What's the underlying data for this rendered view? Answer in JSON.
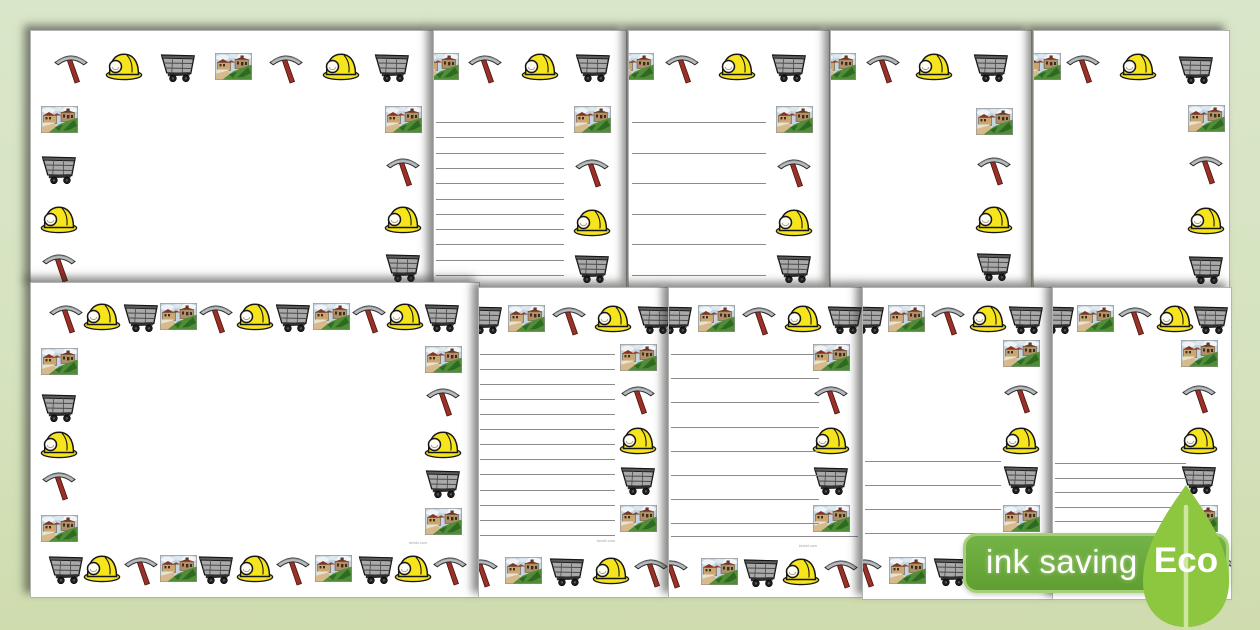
{
  "background_color": "#d6e3c0",
  "page_color": "#ffffff",
  "theme_icons": [
    "pickaxe-icon",
    "mining-helmet-icon",
    "mine-cart-icon",
    "colliery-scene-icon"
  ],
  "watermark_text": "twinkl.com",
  "badge": {
    "label": "ink saving",
    "eco_label": "Eco",
    "badge_color": "#68a93c",
    "badge_border_color": "#a6d075",
    "leaf_color": "#8dc63f",
    "stem_color": "#cde6a0",
    "text_color": "#ffffff"
  },
  "icon_colors": {
    "helmet_yellow": "#f6e41c",
    "pickaxe_handle_red": "#993128",
    "pickaxe_head_grey": "#b9bcbf",
    "cart_grey": "#a9a9a9",
    "scene_sky": "#c4d4e0",
    "scene_grass": "#4f8e36",
    "scene_roof": "#8a3325"
  },
  "pages": [
    {
      "name": "page-landscape-border-blank-top",
      "description": "landscape page border, blank, partially hidden",
      "x": 30,
      "y": 30,
      "w": 404,
      "h": 257,
      "z": 1,
      "icons": [
        {
          "t": "pickaxe",
          "x": 40,
          "y": 35
        },
        {
          "t": "helmet",
          "x": 93,
          "y": 35
        },
        {
          "t": "cart",
          "x": 147,
          "y": 35
        },
        {
          "t": "scene",
          "x": 202,
          "y": 35
        },
        {
          "t": "pickaxe",
          "x": 255,
          "y": 35
        },
        {
          "t": "helmet",
          "x": 310,
          "y": 35
        },
        {
          "t": "cart",
          "x": 361,
          "y": 35
        },
        {
          "t": "scene",
          "x": 28,
          "y": 88
        },
        {
          "t": "cart",
          "x": 28,
          "y": 137
        },
        {
          "t": "helmet",
          "x": 28,
          "y": 188
        },
        {
          "t": "pickaxe",
          "x": 28,
          "y": 234
        },
        {
          "t": "scene",
          "x": 372,
          "y": 88
        },
        {
          "t": "pickaxe",
          "x": 372,
          "y": 138
        },
        {
          "t": "helmet",
          "x": 372,
          "y": 188
        },
        {
          "t": "cart",
          "x": 372,
          "y": 235
        }
      ],
      "lines": [],
      "watermark": null
    },
    {
      "name": "page-portrait-narrow-lined-top",
      "description": "portrait border with narrow writing lines, partially hidden",
      "x": 433,
      "y": 30,
      "w": 194,
      "h": 258,
      "z": 2,
      "icons": [
        {
          "t": "scene",
          "x": 6,
          "y": 35
        },
        {
          "t": "pickaxe",
          "x": 51,
          "y": 35
        },
        {
          "t": "helmet",
          "x": 106,
          "y": 35
        },
        {
          "t": "cart",
          "x": 159,
          "y": 35
        },
        {
          "t": "scene",
          "x": 158,
          "y": 88
        },
        {
          "t": "pickaxe",
          "x": 158,
          "y": 139
        },
        {
          "t": "helmet",
          "x": 158,
          "y": 191
        },
        {
          "t": "cart",
          "x": 158,
          "y": 236
        }
      ],
      "lines": [
        {
          "count": 11,
          "x": 2,
          "width": 128,
          "top": 91,
          "spacing": 15.3
        }
      ],
      "watermark": null
    },
    {
      "name": "page-portrait-wide-lined-top",
      "description": "portrait border with wide writing lines, partially hidden",
      "x": 628,
      "y": 30,
      "w": 202,
      "h": 258,
      "z": 3,
      "icons": [
        {
          "t": "scene",
          "x": 6,
          "y": 35
        },
        {
          "t": "pickaxe",
          "x": 53,
          "y": 35
        },
        {
          "t": "helmet",
          "x": 108,
          "y": 35
        },
        {
          "t": "cart",
          "x": 160,
          "y": 35
        },
        {
          "t": "scene",
          "x": 165,
          "y": 88
        },
        {
          "t": "pickaxe",
          "x": 165,
          "y": 139
        },
        {
          "t": "helmet",
          "x": 165,
          "y": 191
        },
        {
          "t": "cart",
          "x": 165,
          "y": 236
        }
      ],
      "lines": [
        {
          "count": 6,
          "x": 3,
          "width": 134,
          "top": 91,
          "spacing": 30.5
        }
      ],
      "watermark": null
    },
    {
      "name": "page-portrait-blank-top-1",
      "description": "portrait border, blank, partially hidden",
      "x": 830,
      "y": 30,
      "w": 202,
      "h": 258,
      "z": 4,
      "icons": [
        {
          "t": "scene",
          "x": 6,
          "y": 35
        },
        {
          "t": "pickaxe",
          "x": 52,
          "y": 35
        },
        {
          "t": "helmet",
          "x": 103,
          "y": 35
        },
        {
          "t": "cart",
          "x": 160,
          "y": 35
        },
        {
          "t": "scene",
          "x": 163,
          "y": 90
        },
        {
          "t": "pickaxe",
          "x": 163,
          "y": 137
        },
        {
          "t": "helmet",
          "x": 163,
          "y": 188
        },
        {
          "t": "cart",
          "x": 163,
          "y": 234
        }
      ],
      "lines": [],
      "watermark": null
    },
    {
      "name": "page-portrait-blank-top-2",
      "description": "portrait border, blank, partially hidden",
      "x": 1033,
      "y": 30,
      "w": 197,
      "h": 258,
      "z": 5,
      "icons": [
        {
          "t": "scene",
          "x": 8,
          "y": 35
        },
        {
          "t": "pickaxe",
          "x": 49,
          "y": 35
        },
        {
          "t": "helmet",
          "x": 104,
          "y": 35
        },
        {
          "t": "cart",
          "x": 162,
          "y": 37
        },
        {
          "t": "scene",
          "x": 172,
          "y": 87
        },
        {
          "t": "pickaxe",
          "x": 172,
          "y": 136
        },
        {
          "t": "helmet",
          "x": 172,
          "y": 189
        },
        {
          "t": "cart",
          "x": 172,
          "y": 237
        }
      ],
      "lines": [],
      "watermark": null
    },
    {
      "name": "page-landscape-border-blank",
      "description": "landscape full border, blank",
      "x": 30,
      "y": 282,
      "w": 450,
      "h": 316,
      "z": 6,
      "icons": [
        {
          "t": "pickaxe",
          "x": 35,
          "y": 33
        },
        {
          "t": "helmet",
          "x": 71,
          "y": 33
        },
        {
          "t": "cart",
          "x": 110,
          "y": 33
        },
        {
          "t": "scene",
          "x": 147,
          "y": 33
        },
        {
          "t": "pickaxe",
          "x": 185,
          "y": 33
        },
        {
          "t": "helmet",
          "x": 224,
          "y": 33
        },
        {
          "t": "cart",
          "x": 262,
          "y": 33
        },
        {
          "t": "scene",
          "x": 300,
          "y": 33
        },
        {
          "t": "pickaxe",
          "x": 338,
          "y": 33
        },
        {
          "t": "helmet",
          "x": 374,
          "y": 33
        },
        {
          "t": "cart",
          "x": 411,
          "y": 33
        },
        {
          "t": "scene",
          "x": 28,
          "y": 78
        },
        {
          "t": "cart",
          "x": 28,
          "y": 123
        },
        {
          "t": "helmet",
          "x": 28,
          "y": 161
        },
        {
          "t": "pickaxe",
          "x": 28,
          "y": 200
        },
        {
          "t": "scene",
          "x": 28,
          "y": 245
        },
        {
          "t": "scene",
          "x": 412,
          "y": 76
        },
        {
          "t": "pickaxe",
          "x": 412,
          "y": 116
        },
        {
          "t": "helmet",
          "x": 412,
          "y": 161
        },
        {
          "t": "cart",
          "x": 412,
          "y": 199
        },
        {
          "t": "scene",
          "x": 412,
          "y": 238
        },
        {
          "t": "cart",
          "x": 35,
          "y": 285
        },
        {
          "t": "helmet",
          "x": 71,
          "y": 285
        },
        {
          "t": "pickaxe",
          "x": 110,
          "y": 285
        },
        {
          "t": "scene",
          "x": 147,
          "y": 285
        },
        {
          "t": "cart",
          "x": 185,
          "y": 285
        },
        {
          "t": "helmet",
          "x": 224,
          "y": 285
        },
        {
          "t": "pickaxe",
          "x": 262,
          "y": 285
        },
        {
          "t": "scene",
          "x": 302,
          "y": 285
        },
        {
          "t": "cart",
          "x": 345,
          "y": 285
        },
        {
          "t": "helmet",
          "x": 382,
          "y": 285
        },
        {
          "t": "pickaxe",
          "x": 419,
          "y": 285
        }
      ],
      "lines": [],
      "watermark": {
        "x": 378,
        "y": 258
      }
    },
    {
      "name": "page-portrait-narrow-lined",
      "description": "portrait full border with narrow writing lines",
      "x": 478,
      "y": 287,
      "w": 191,
      "h": 311,
      "z": 7,
      "icons": [
        {
          "t": "cart",
          "x": 6,
          "y": 30
        },
        {
          "t": "scene",
          "x": 47,
          "y": 30
        },
        {
          "t": "pickaxe",
          "x": 90,
          "y": 30
        },
        {
          "t": "helmet",
          "x": 134,
          "y": 30
        },
        {
          "t": "cart",
          "x": 176,
          "y": 30
        },
        {
          "t": "scene",
          "x": 159,
          "y": 69
        },
        {
          "t": "pickaxe",
          "x": 159,
          "y": 109
        },
        {
          "t": "helmet",
          "x": 159,
          "y": 152
        },
        {
          "t": "cart",
          "x": 159,
          "y": 191
        },
        {
          "t": "scene",
          "x": 159,
          "y": 230
        },
        {
          "t": "pickaxe",
          "x": 2,
          "y": 282
        },
        {
          "t": "scene",
          "x": 44,
          "y": 282
        },
        {
          "t": "cart",
          "x": 88,
          "y": 282
        },
        {
          "t": "helmet",
          "x": 132,
          "y": 282
        },
        {
          "t": "pickaxe",
          "x": 172,
          "y": 282
        }
      ],
      "lines": [
        {
          "count": 13,
          "x": 1,
          "width": 135,
          "top": 66,
          "spacing": 15.05
        }
      ],
      "watermark": {
        "x": 118,
        "y": 251
      }
    },
    {
      "name": "page-portrait-wide-lined",
      "description": "portrait full border with wide writing lines",
      "x": 668,
      "y": 287,
      "w": 195,
      "h": 311,
      "z": 8,
      "icons": [
        {
          "t": "cart",
          "x": 6,
          "y": 30
        },
        {
          "t": "scene",
          "x": 47,
          "y": 30
        },
        {
          "t": "pickaxe",
          "x": 90,
          "y": 30
        },
        {
          "t": "helmet",
          "x": 134,
          "y": 30
        },
        {
          "t": "cart",
          "x": 176,
          "y": 30
        },
        {
          "t": "scene",
          "x": 162,
          "y": 69
        },
        {
          "t": "pickaxe",
          "x": 162,
          "y": 109
        },
        {
          "t": "helmet",
          "x": 162,
          "y": 152
        },
        {
          "t": "cart",
          "x": 162,
          "y": 191
        },
        {
          "t": "scene",
          "x": 162,
          "y": 230
        },
        {
          "t": "pickaxe",
          "x": 2,
          "y": 283
        },
        {
          "t": "scene",
          "x": 50,
          "y": 283
        },
        {
          "t": "cart",
          "x": 92,
          "y": 283
        },
        {
          "t": "helmet",
          "x": 132,
          "y": 283
        },
        {
          "t": "pickaxe",
          "x": 172,
          "y": 283
        }
      ],
      "lines": [
        {
          "count": 8,
          "x": 2,
          "width": 148,
          "top": 66,
          "spacing": 24.2
        },
        {
          "count": 1,
          "x": 2,
          "width": 187,
          "top": 248,
          "spacing": 1
        }
      ],
      "watermark": {
        "x": 130,
        "y": 256
      }
    },
    {
      "name": "page-portrait-half-lined-wide",
      "description": "portrait full border, wide lines on lower half only",
      "x": 862,
      "y": 287,
      "w": 191,
      "h": 313,
      "z": 9,
      "icons": [
        {
          "t": "cart",
          "x": 4,
          "y": 30
        },
        {
          "t": "scene",
          "x": 43,
          "y": 30
        },
        {
          "t": "pickaxe",
          "x": 85,
          "y": 30
        },
        {
          "t": "helmet",
          "x": 125,
          "y": 30
        },
        {
          "t": "cart",
          "x": 163,
          "y": 30
        },
        {
          "t": "scene",
          "x": 158,
          "y": 65
        },
        {
          "t": "pickaxe",
          "x": 158,
          "y": 108
        },
        {
          "t": "helmet",
          "x": 158,
          "y": 152
        },
        {
          "t": "cart",
          "x": 158,
          "y": 190
        },
        {
          "t": "scene",
          "x": 158,
          "y": 230
        },
        {
          "t": "pickaxe",
          "x": 2,
          "y": 282
        },
        {
          "t": "scene",
          "x": 44,
          "y": 282
        },
        {
          "t": "cart",
          "x": 88,
          "y": 282
        },
        {
          "t": "helmet",
          "x": 132,
          "y": 282
        },
        {
          "t": "pickaxe",
          "x": 172,
          "y": 282
        }
      ],
      "lines": [
        {
          "count": 4,
          "x": 2,
          "width": 136,
          "top": 173,
          "spacing": 24
        }
      ],
      "watermark": null
    },
    {
      "name": "page-portrait-half-lined-narrow",
      "description": "portrait full border, narrow lines on lower half only",
      "x": 1052,
      "y": 287,
      "w": 180,
      "h": 313,
      "z": 10,
      "icons": [
        {
          "t": "cart",
          "x": 4,
          "y": 30
        },
        {
          "t": "scene",
          "x": 42,
          "y": 30
        },
        {
          "t": "pickaxe",
          "x": 82,
          "y": 30
        },
        {
          "t": "helmet",
          "x": 122,
          "y": 30
        },
        {
          "t": "cart",
          "x": 158,
          "y": 30
        },
        {
          "t": "scene",
          "x": 146,
          "y": 65
        },
        {
          "t": "pickaxe",
          "x": 146,
          "y": 108
        },
        {
          "t": "helmet",
          "x": 146,
          "y": 152
        },
        {
          "t": "cart",
          "x": 146,
          "y": 190
        },
        {
          "t": "scene",
          "x": 146,
          "y": 230
        },
        {
          "t": "pickaxe",
          "x": 2,
          "y": 280
        },
        {
          "t": "scene",
          "x": 42,
          "y": 280
        },
        {
          "t": "cart",
          "x": 84,
          "y": 280
        },
        {
          "t": "helmet",
          "x": 126,
          "y": 280
        },
        {
          "t": "pickaxe",
          "x": 166,
          "y": 280
        }
      ],
      "lines": [
        {
          "count": 6,
          "x": 2,
          "width": 131,
          "top": 175,
          "spacing": 14.6
        }
      ],
      "watermark": null
    }
  ]
}
